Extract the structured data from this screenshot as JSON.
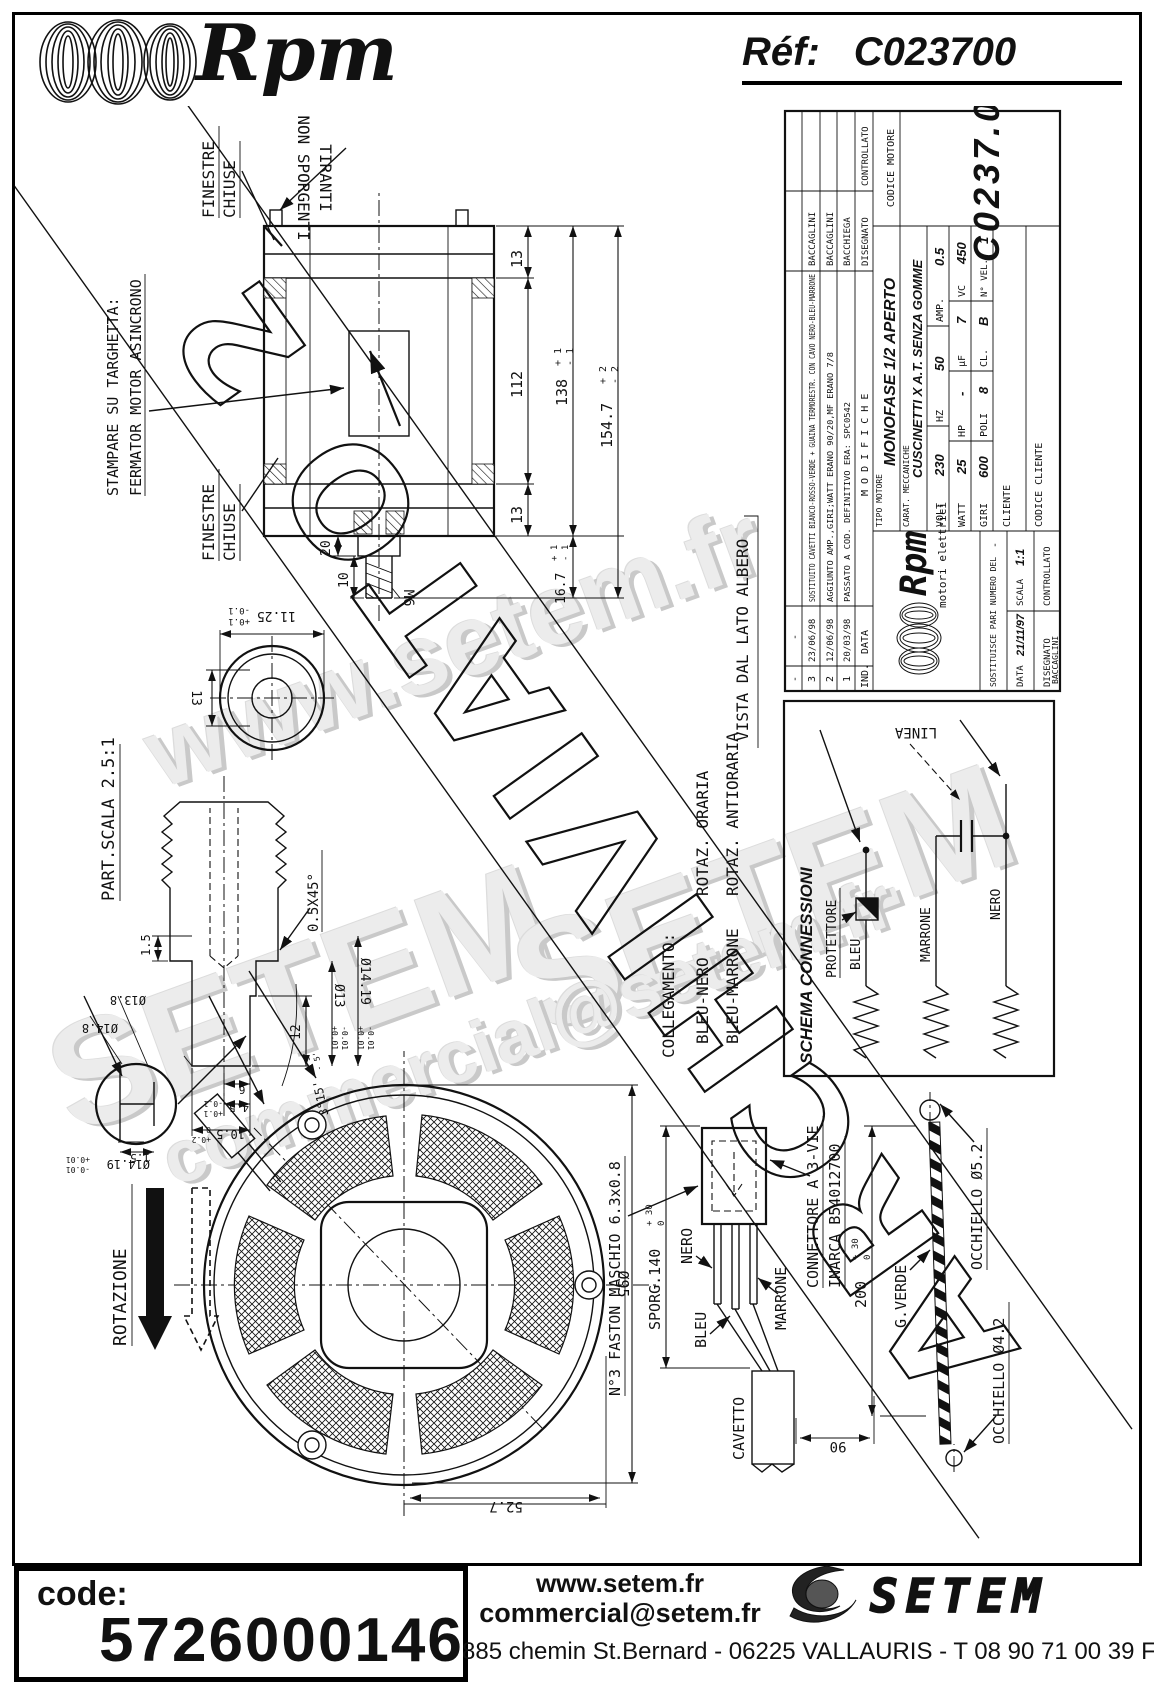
{
  "header": {
    "brand": "Rpm",
    "ref_label": "Réf:",
    "ref_value": "C023700"
  },
  "watermarks": {
    "site": "www.setem.fr",
    "brand1": "SETEM",
    "brand2": "SETEM",
    "email": "commercial@setem.fr"
  },
  "banner": {
    "text": "ARCHIVIATO 2"
  },
  "labels": {
    "finestre1a": "FINESTRE",
    "finestre1b": "CHIUSE",
    "finestre2a": "FINESTRE",
    "finestre2b": "CHIUSE",
    "tiranti_a": "TIRANTI",
    "tiranti_b": "NON SPORGENTI",
    "stampare": "STAMPARE SU TARGHETTA:",
    "fermator": "FERMATOR MOTOR ASINCRONO",
    "part_scala": "PART.SCALA 2.5:1",
    "vista": "VISTA DAL LATO ALBERO",
    "rotazione": "ROTAZIONE",
    "collegamento": "COLLEGAMENTO:",
    "bleu_nero": "BLEU-NERO",
    "rotaz_oraria": "ROTAZ. ORARIA",
    "bleu_marrone": "BLEU-MARRONE",
    "rotaz_antioraria": "ROTAZ. ANTIORARIA",
    "faston": "N°3 FASTON MASCHIO 6.3x0.8",
    "sporg": "SPORG.140",
    "nero": "NERO",
    "bleu": "BLEU",
    "marrone": "MARRONE",
    "connettore1": "CONNETTORE A 3-VIE",
    "connettore2": "INARCA B54012700",
    "cavetto": "CAVETTO",
    "g_verde": "G.VERDE",
    "occhiello52": "OCCHIELLO Ø5.2",
    "occhiello42": "OCCHIELLO Ø4.2"
  },
  "dims": {
    "d13top": "13",
    "d112": "112",
    "d13bot": "13",
    "d138": "138",
    "d1547": "154.7",
    "d167": "16.7",
    "tol_p1": "+ 1",
    "tol_m1": "- 1",
    "tol_p2": "+ 2",
    "tol_m2": "- 2",
    "d20": "20",
    "d10": "10",
    "m6": "M6",
    "d1125": "11.25",
    "tol_p01": "+0.1",
    "tol_m01": "-0.1",
    "d13c": "13",
    "d105": "10.5",
    "tol_p02": "+0.2",
    "tol_z": "0",
    "d45": "4.5",
    "d6": "6",
    "d15": "1.5",
    "d12": "12",
    "chamfer": "0.5X45°",
    "angle": "3°15'",
    "tol_p5": "+ 5'",
    "tol_m5": "- 5'",
    "dia13": "Ø13",
    "tol_p001": "+0.01",
    "tol_m001": "-0.01",
    "dia1419": "Ø14.19",
    "dia148": "Ø14.8",
    "dia138": "Ø13.8",
    "d15b": "1.5",
    "d527": "52.7",
    "dia95": "Ø95",
    "d90": "90",
    "d200": "200",
    "tol_p30": "+ 30",
    "tol_z2": "0"
  },
  "schema": {
    "title": "SCHEMA CONNESSIONI",
    "protettore": "PROTETTORE",
    "bleu": "BLEU",
    "marrone": "MARRONE",
    "nero": "NERO",
    "linea": "LINEA"
  },
  "titleblock": {
    "rev": [
      {
        "ind": "-",
        "date": "-",
        "mod": "",
        "name": ""
      },
      {
        "ind": "3",
        "date": "23/06/98",
        "mod": "SOSTITUITO CAVETTI BIANCO-ROSSO-VERDE + GUAINA TERMORESTR. CON CAVO NERO-BLEU-MARRONE",
        "name": "BACCAGLINI"
      },
      {
        "ind": "2",
        "date": "12/06/98",
        "mod": "AGGIUNTO AMP.,GIRI;WATT ERANO 90/20,MF ERANO 7/8",
        "name": "BACCAGLINI"
      },
      {
        "ind": "1",
        "date": "20/03/98",
        "mod": "PASSATO A COD. DEFINITIVO ERA: SPC0542",
        "name": "BACCHIEGA"
      },
      {
        "ind": "IND.",
        "date": "DATA",
        "mod": "M O D I F I C H E",
        "name": "DISEGNATO",
        "name2": "CONTROLLATO"
      }
    ],
    "logo_brand": "Rpm",
    "logo_sub": "motori elettrici",
    "sostituisce": "SOSTITUISCE PARI NUMERO DEL",
    "sostituisce_val": "-",
    "scala": "SCALA",
    "scala_val": "1:1",
    "data": "DATA",
    "data_val": "21/11/97",
    "disegnato": "DISEGNATO",
    "disegnato_val": "BACCAGLINI",
    "controllato": "CONTROLLATO",
    "tipo": "TIPO MOTORE",
    "tipo_val": "MONOFASE 1/2 APERTO",
    "carat": "CARAT. MECCANICHE",
    "carat_val": "CUSCINETTI X A.T. SENZA GOMME",
    "specs": [
      {
        "l": "VOLT",
        "v": "230"
      },
      {
        "l": "HZ",
        "v": "50"
      },
      {
        "l": "AMP.",
        "v": "0.5"
      },
      {
        "l": "WATT",
        "v": "25"
      },
      {
        "l": "HP",
        "v": "-"
      },
      {
        "l": "µF",
        "v": "7"
      },
      {
        "l": "VC",
        "v": "450"
      },
      {
        "l": "GIRI",
        "v": "600"
      },
      {
        "l": "POLI",
        "v": "8"
      },
      {
        "l": "CL.",
        "v": "B"
      },
      {
        "l": "N° VEL.",
        "v": "1"
      }
    ],
    "cliente": "CLIENTE",
    "codice_cliente": "CODICE CLIENTE",
    "codice_motore": "CODICE MOTORE",
    "codice_val": "C0237.00"
  },
  "footer": {
    "code_label": "code:",
    "code_value": "5726000146",
    "website": "www.setem.fr",
    "email": "commercial@setem.fr",
    "address": "885 chemin St.Bernard  -  06225 VALLAURIS  -  T 08 90 71 00 39   F 04 92 95 19 39",
    "logo": "SETEM"
  }
}
